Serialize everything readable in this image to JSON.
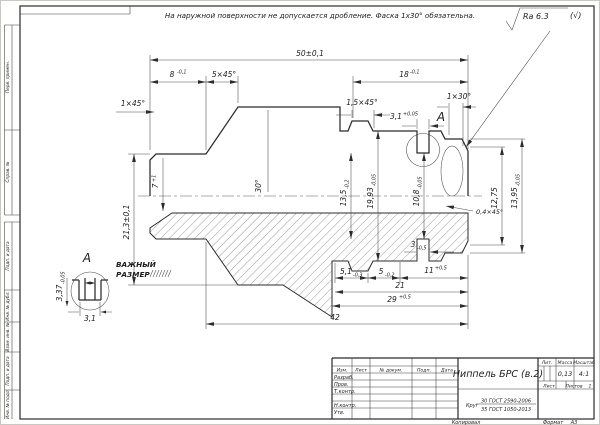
{
  "note": "На наружной поверхности не допускается дробление. Фаска 1х30° обязательна.",
  "roughness": {
    "value": "Ra 6.3",
    "alt": "(√)"
  },
  "frame": {
    "stamps_top": [
      "Перв. примен.",
      "Справ. №"
    ],
    "stamps_bottom": [
      "Подп. и дата",
      "Инв. № дубл.",
      "Взам. инв. №",
      "Подп. и дата",
      "Инв. № подл."
    ]
  },
  "view_a": {
    "label": "А",
    "dim_height": {
      "value": "3,37",
      "tol": "-0,05"
    },
    "dim_width": {
      "value": "3,1"
    },
    "note_line1": "ВАЖНЫЙ",
    "note_line2": "РАЗМЕР"
  },
  "dims": {
    "total": {
      "value": "50±0,1"
    },
    "len8": {
      "value": "8",
      "tol": "-0,1"
    },
    "ch5": {
      "value": "5×45°"
    },
    "len18": {
      "value": "18",
      "tol": "-0,1"
    },
    "ch1": {
      "value": "1×45°"
    },
    "ch15": {
      "value": "1,5×45°"
    },
    "groove31": {
      "value": "3,1",
      "tol": "+0,05"
    },
    "ch130": {
      "value": "1×30°"
    },
    "dia213": {
      "value": "21,3±0,1"
    },
    "depth7": {
      "value": "7",
      "tol": "+1"
    },
    "angle30": {
      "value": "30°"
    },
    "dia135": {
      "value": "13,5",
      "tol": "-0,2"
    },
    "dia1993": {
      "value": "19,93",
      "tol": "-0,05"
    },
    "dia108": {
      "value": "10,8",
      "tol": "-0,05"
    },
    "dia1275": {
      "value": "12,75"
    },
    "dia1395": {
      "value": "13,95",
      "tol": "-0,05"
    },
    "ch04": {
      "value": "0,4×45°"
    },
    "w3": {
      "value": "3",
      "tol": "-0,5"
    },
    "w51": {
      "value": "5,1",
      "tol": "-0,3"
    },
    "w5": {
      "value": "5",
      "tol": "-0,2"
    },
    "w11": {
      "value": "11",
      "tol": "+0,5"
    },
    "len21": {
      "value": "21"
    },
    "len29": {
      "value": "29",
      "tol": "+0,5"
    },
    "len42": {
      "value": "42"
    }
  },
  "title_block": {
    "name": "Ниппель БРС (в.2)",
    "material_prefix": "Круг",
    "material_top": "30 ГОСТ 2590-2006",
    "material_bottom": "35 ГОСТ 1050-2013",
    "header_lit": "Лит.",
    "header_mass": "Масса",
    "header_scale": "Масштаб",
    "mass": "0,13",
    "scale": "4:1",
    "sheet_label": "Лист",
    "sheets_label": "Листов",
    "sheets_value": "1",
    "col_izm": "Изм.",
    "col_list": "Лист",
    "col_doc": "№ докум.",
    "col_sign": "Подп.",
    "col_date": "Дата",
    "row_razrab": "Разраб.",
    "row_prov": "Пров.",
    "row_tcontr": "Т.контр.",
    "row_ncontr": "Н.контр.",
    "row_utv": "Утв.",
    "kopiroval": "Копировал",
    "format_label": "Формат",
    "format_value": "А3"
  }
}
